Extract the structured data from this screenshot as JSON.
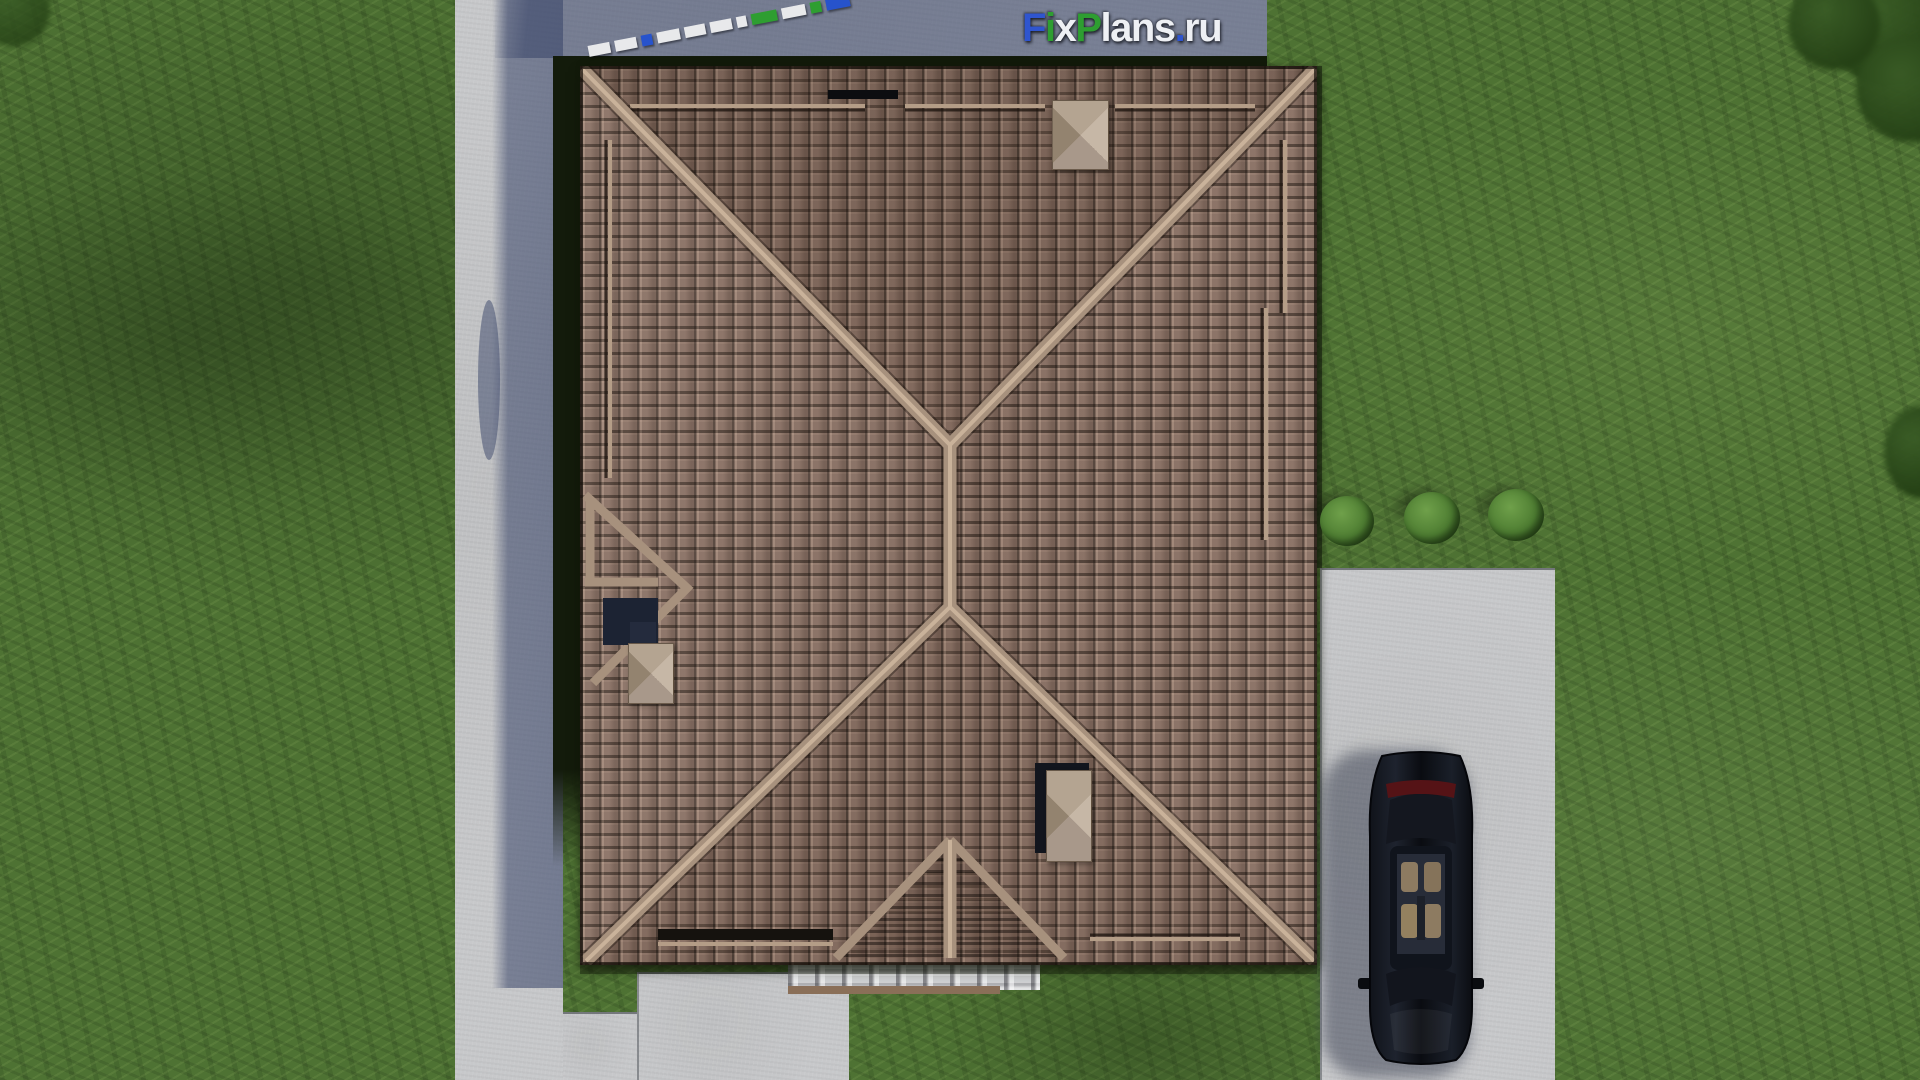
{
  "watermark": {
    "text": "FixPlans.ru",
    "letters": [
      {
        "ch": "F",
        "color": "#2f55cf"
      },
      {
        "ch": "i",
        "color": "#2e9e31"
      },
      {
        "ch": "x",
        "color": "#eef0f4"
      },
      {
        "ch": "P",
        "color": "#2e9e31"
      },
      {
        "ch": "l",
        "color": "#eef0f4"
      },
      {
        "ch": "a",
        "color": "#eef0f4"
      },
      {
        "ch": "n",
        "color": "#eef0f4"
      },
      {
        "ch": "s",
        "color": "#eef0f4"
      },
      {
        "ch": ".",
        "color": "#2f55cf"
      },
      {
        "ch": "r",
        "color": "#eef0f4"
      },
      {
        "ch": "u",
        "color": "#eef0f4"
      }
    ]
  },
  "scale_bar": {
    "segments": [
      {
        "color": "#e8e9eb",
        "len": 22,
        "tall": false
      },
      {
        "color": "#e8e9eb",
        "len": 22,
        "tall": false
      },
      {
        "color": "#2753cc",
        "len": 11,
        "tall": false
      },
      {
        "color": "#e8e9eb",
        "len": 23,
        "tall": false
      },
      {
        "color": "#e8e9eb",
        "len": 21,
        "tall": false
      },
      {
        "color": "#e8e9eb",
        "len": 22,
        "tall": false
      },
      {
        "color": "#e8e9eb",
        "len": 10,
        "tall": false
      },
      {
        "color": "#2e9e31",
        "len": 26,
        "tall": false
      },
      {
        "color": "#e8e9eb",
        "len": 24,
        "tall": false
      },
      {
        "color": "#2e9e31",
        "len": 11,
        "tall": false
      },
      {
        "color": "#2753cc",
        "len": 24,
        "tall": true
      }
    ]
  },
  "colors": {
    "grass": "#4e7233",
    "grass_shadow": "#2c4a1e",
    "roof_tile": "#8d7468",
    "roof_tile_dark": "#241d18",
    "roof_ridge": "#a7917d",
    "chimney_cap": "#b3a494",
    "concrete": "#c7c8ca",
    "gravel": "#cfd0d2",
    "shadow_blue": "#3c4468",
    "wall_dark": "#131b0b",
    "bush": "#4e7d32",
    "car": "#0c0f15",
    "logo_blue": "#2753cc",
    "logo_green": "#2e9e31",
    "logo_white": "#eef0f4"
  },
  "scene_objects": [
    "tiled hip roof with chimneys",
    "left garden path",
    "top walkway",
    "concrete driveway",
    "black sedan car (top view)",
    "white gravel border",
    "rear patio",
    "three bushes",
    "lawn",
    "roof scale bar",
    "FixPlans.ru watermark"
  ]
}
